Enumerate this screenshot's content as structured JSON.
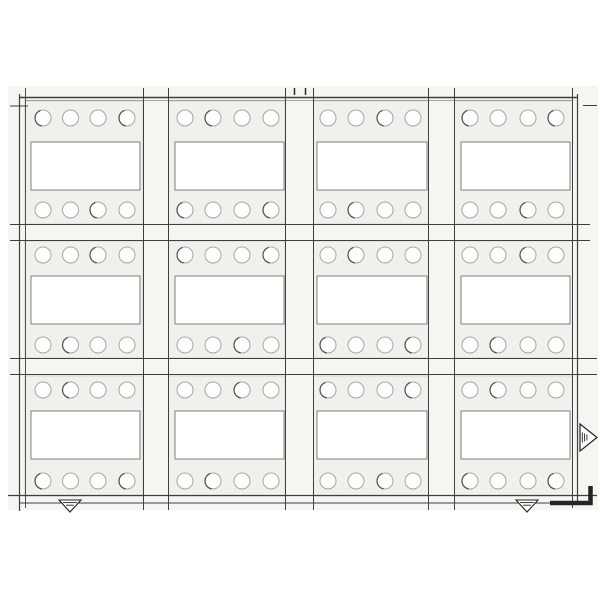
{
  "drawing": {
    "kind": "scanned die-cut sheet layout",
    "canvas": {
      "width": 600,
      "height": 600
    },
    "sheet": {
      "x": 8,
      "y": 86,
      "w": 590,
      "h": 424
    }
  },
  "colors": {
    "page_bg": "#ffffff",
    "sheet_bg": "#f5f5f2",
    "panel_bg": "#f0f0ec",
    "panel_edge": "#cfcfc8",
    "window_fill": "#ffffff",
    "window_edge": "#73736b",
    "hole_fill": "#fefefd",
    "hole_edge": "#a8a89e",
    "hole_edge_dark": "#54544c",
    "line": "#3f3f3b",
    "line_soft": "#8a8a80",
    "mark": "#232320"
  },
  "grid": {
    "hole_radius": 8,
    "columns": [
      {
        "left": 25,
        "width": 118,
        "holes_x": [
          43,
          70.5,
          98,
          127
        ],
        "window_x": 31,
        "window_w": 109
      },
      {
        "left": 168.5,
        "width": 116.5,
        "holes_x": [
          185,
          213,
          242,
          271
        ],
        "window_x": 175,
        "window_w": 109
      },
      {
        "left": 313.5,
        "width": 115,
        "holes_x": [
          328,
          356,
          385,
          413
        ],
        "window_x": 317,
        "window_w": 110
      },
      {
        "left": 454.5,
        "width": 118,
        "holes_x": [
          470,
          498,
          528,
          556
        ],
        "window_x": 461,
        "window_w": 109
      }
    ],
    "rows": [
      {
        "top": 101,
        "height": 123,
        "holes_top_y": 118,
        "holes_bottom_y": 210,
        "window_y": 142,
        "window_h": 48
      },
      {
        "top": 241,
        "height": 117,
        "holes_top_y": 255,
        "holes_bottom_y": 345,
        "window_y": 276,
        "window_h": 48
      },
      {
        "top": 376,
        "height": 120,
        "holes_top_y": 390,
        "holes_bottom_y": 481,
        "window_y": 411,
        "window_h": 48
      }
    ]
  },
  "lines": {
    "horizontal": [
      {
        "y": 97.5,
        "x1": 19,
        "x2": 578,
        "sw": 1.5,
        "tone": "line"
      },
      {
        "y": 100.5,
        "x1": 25,
        "x2": 573,
        "sw": 0.8,
        "tone": "line_soft"
      },
      {
        "y": 106,
        "x1": 10,
        "x2": 28,
        "sw": 1,
        "tone": "line"
      },
      {
        "y": 105.5,
        "x1": 583,
        "x2": 597,
        "sw": 1,
        "tone": "line"
      },
      {
        "y": 224.5,
        "x1": 10,
        "x2": 590,
        "sw": 1.1,
        "tone": "line"
      },
      {
        "y": 240.5,
        "x1": 10,
        "x2": 590,
        "sw": 1.1,
        "tone": "line"
      },
      {
        "y": 358.5,
        "x1": 10,
        "x2": 597,
        "sw": 1.1,
        "tone": "line"
      },
      {
        "y": 374.5,
        "x1": 10,
        "x2": 597,
        "sw": 1.1,
        "tone": "line"
      },
      {
        "y": 495.5,
        "x1": 8,
        "x2": 597,
        "sw": 1.2,
        "tone": "line"
      },
      {
        "y": 503,
        "x1": 19,
        "x2": 560,
        "sw": 1,
        "tone": "line"
      }
    ],
    "vertical": [
      {
        "x": 19.5,
        "y1": 94,
        "y2": 511,
        "sw": 1.2
      },
      {
        "x": 25.5,
        "y1": 88,
        "y2": 508,
        "sw": 0.9
      },
      {
        "x": 143.5,
        "y1": 88,
        "y2": 510,
        "sw": 1
      },
      {
        "x": 168.5,
        "y1": 88,
        "y2": 510,
        "sw": 1
      },
      {
        "x": 285.5,
        "y1": 88,
        "y2": 510,
        "sw": 1
      },
      {
        "x": 313.5,
        "y1": 88,
        "y2": 510,
        "sw": 1
      },
      {
        "x": 428.5,
        "y1": 88,
        "y2": 510,
        "sw": 1
      },
      {
        "x": 454.5,
        "y1": 88,
        "y2": 510,
        "sw": 1
      },
      {
        "x": 572.5,
        "y1": 88,
        "y2": 508,
        "sw": 1
      },
      {
        "x": 577.5,
        "y1": 94,
        "y2": 505,
        "sw": 1.2
      }
    ],
    "top_registration_ticks": [
      {
        "x": 294.5,
        "y1": 88,
        "y2": 95
      },
      {
        "x": 305.5,
        "y1": 88,
        "y2": 95
      }
    ]
  },
  "marks": {
    "collation_triangles": [
      {
        "cx": 70,
        "top": 500,
        "bottom": 512,
        "half_width": 11
      },
      {
        "cx": 527,
        "top": 500,
        "bottom": 512,
        "half_width": 11
      }
    ],
    "direction_arrow": {
      "base_x": 580,
      "tip_x": 597,
      "cy": 437.5,
      "half_height": 13.5,
      "hatch_xs": [
        582.3,
        584.6,
        586.9
      ]
    },
    "corner_bracket": {
      "x1": 550,
      "y": 503,
      "x2": 590.5,
      "y_up": 486,
      "sw": 4.5
    }
  }
}
